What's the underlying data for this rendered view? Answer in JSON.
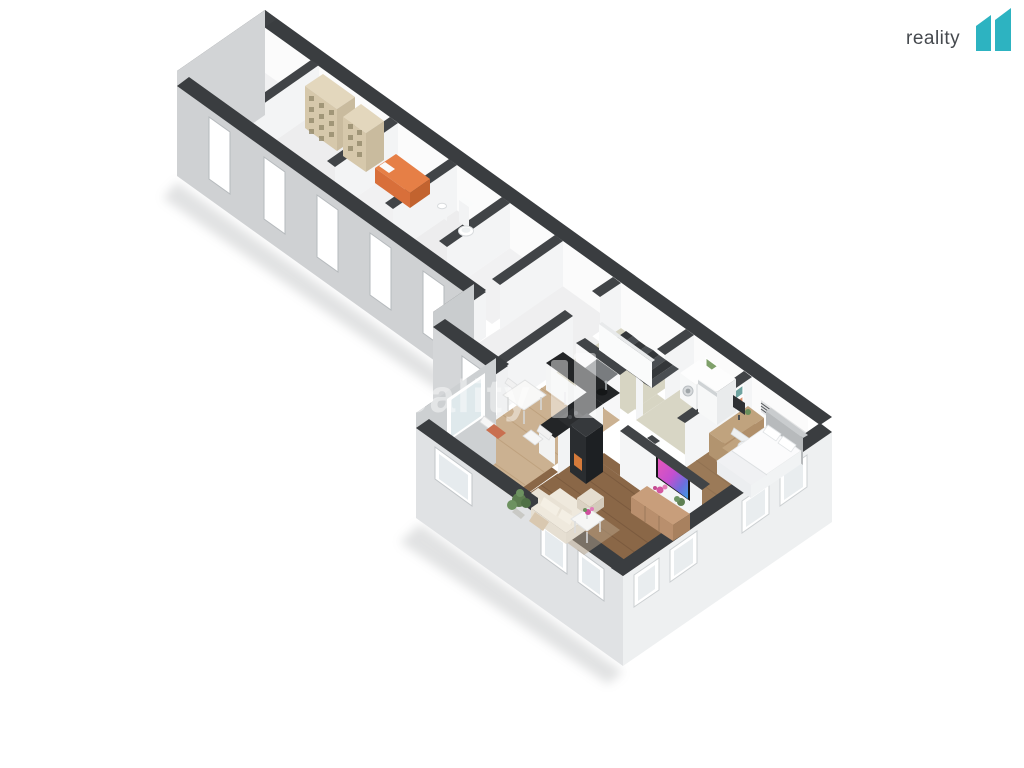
{
  "header": {
    "logo": {
      "text": "reality",
      "mark": "11",
      "mark_color": "#2db3c1",
      "text_color": "#45494e"
    }
  },
  "watermark": {
    "text": "reality",
    "mark": "11",
    "color": "#ffffff",
    "opacity": 0.45
  },
  "scene": {
    "type": "isometric-3d-floor-plan",
    "background": "#ffffff",
    "palette": {
      "wall_top": "#3a3d40",
      "wall_interior": "#f4f5f6",
      "wall_exterior": "#d2d4d6",
      "wall_exterior_bright": "#eef0f1",
      "floor_corridor": "#f0f0f1",
      "floor_hall": "#d7d5c3",
      "floor_kitchen": "#cbb191",
      "floor_living": "#8a6747",
      "floor_bedroom": "#9b7a58",
      "accent_orange": "#e07a42",
      "shelf_tan": "#d6c8ab",
      "tv_screen_gradient": [
        "#e858b8",
        "#c44fd0",
        "#3f9de3"
      ]
    },
    "rooms": [
      "storage-room-1",
      "storage-room-2",
      "storage-room-3",
      "storage-room-4",
      "storage-room-5",
      "entry-corridor",
      "entry-vestibule",
      "hallway-with-stairs",
      "laundry",
      "kitchen-dining",
      "living-room",
      "bedroom"
    ],
    "furniture": [
      "shelving-units",
      "storage-bed",
      "toilet",
      "hand-sink",
      "staircase",
      "doormat",
      "washing-machine",
      "dryer",
      "kitchen-counter",
      "kitchen-sink",
      "cooktop",
      "dining-table",
      "dining-chairs",
      "fireplace",
      "sofa",
      "pouf",
      "rug",
      "coffee-table",
      "flowers",
      "tv",
      "sideboard",
      "plants",
      "double-bed",
      "pillows",
      "desk",
      "desk-chair",
      "monitor",
      "wall-pictures",
      "wall-shelf"
    ]
  }
}
